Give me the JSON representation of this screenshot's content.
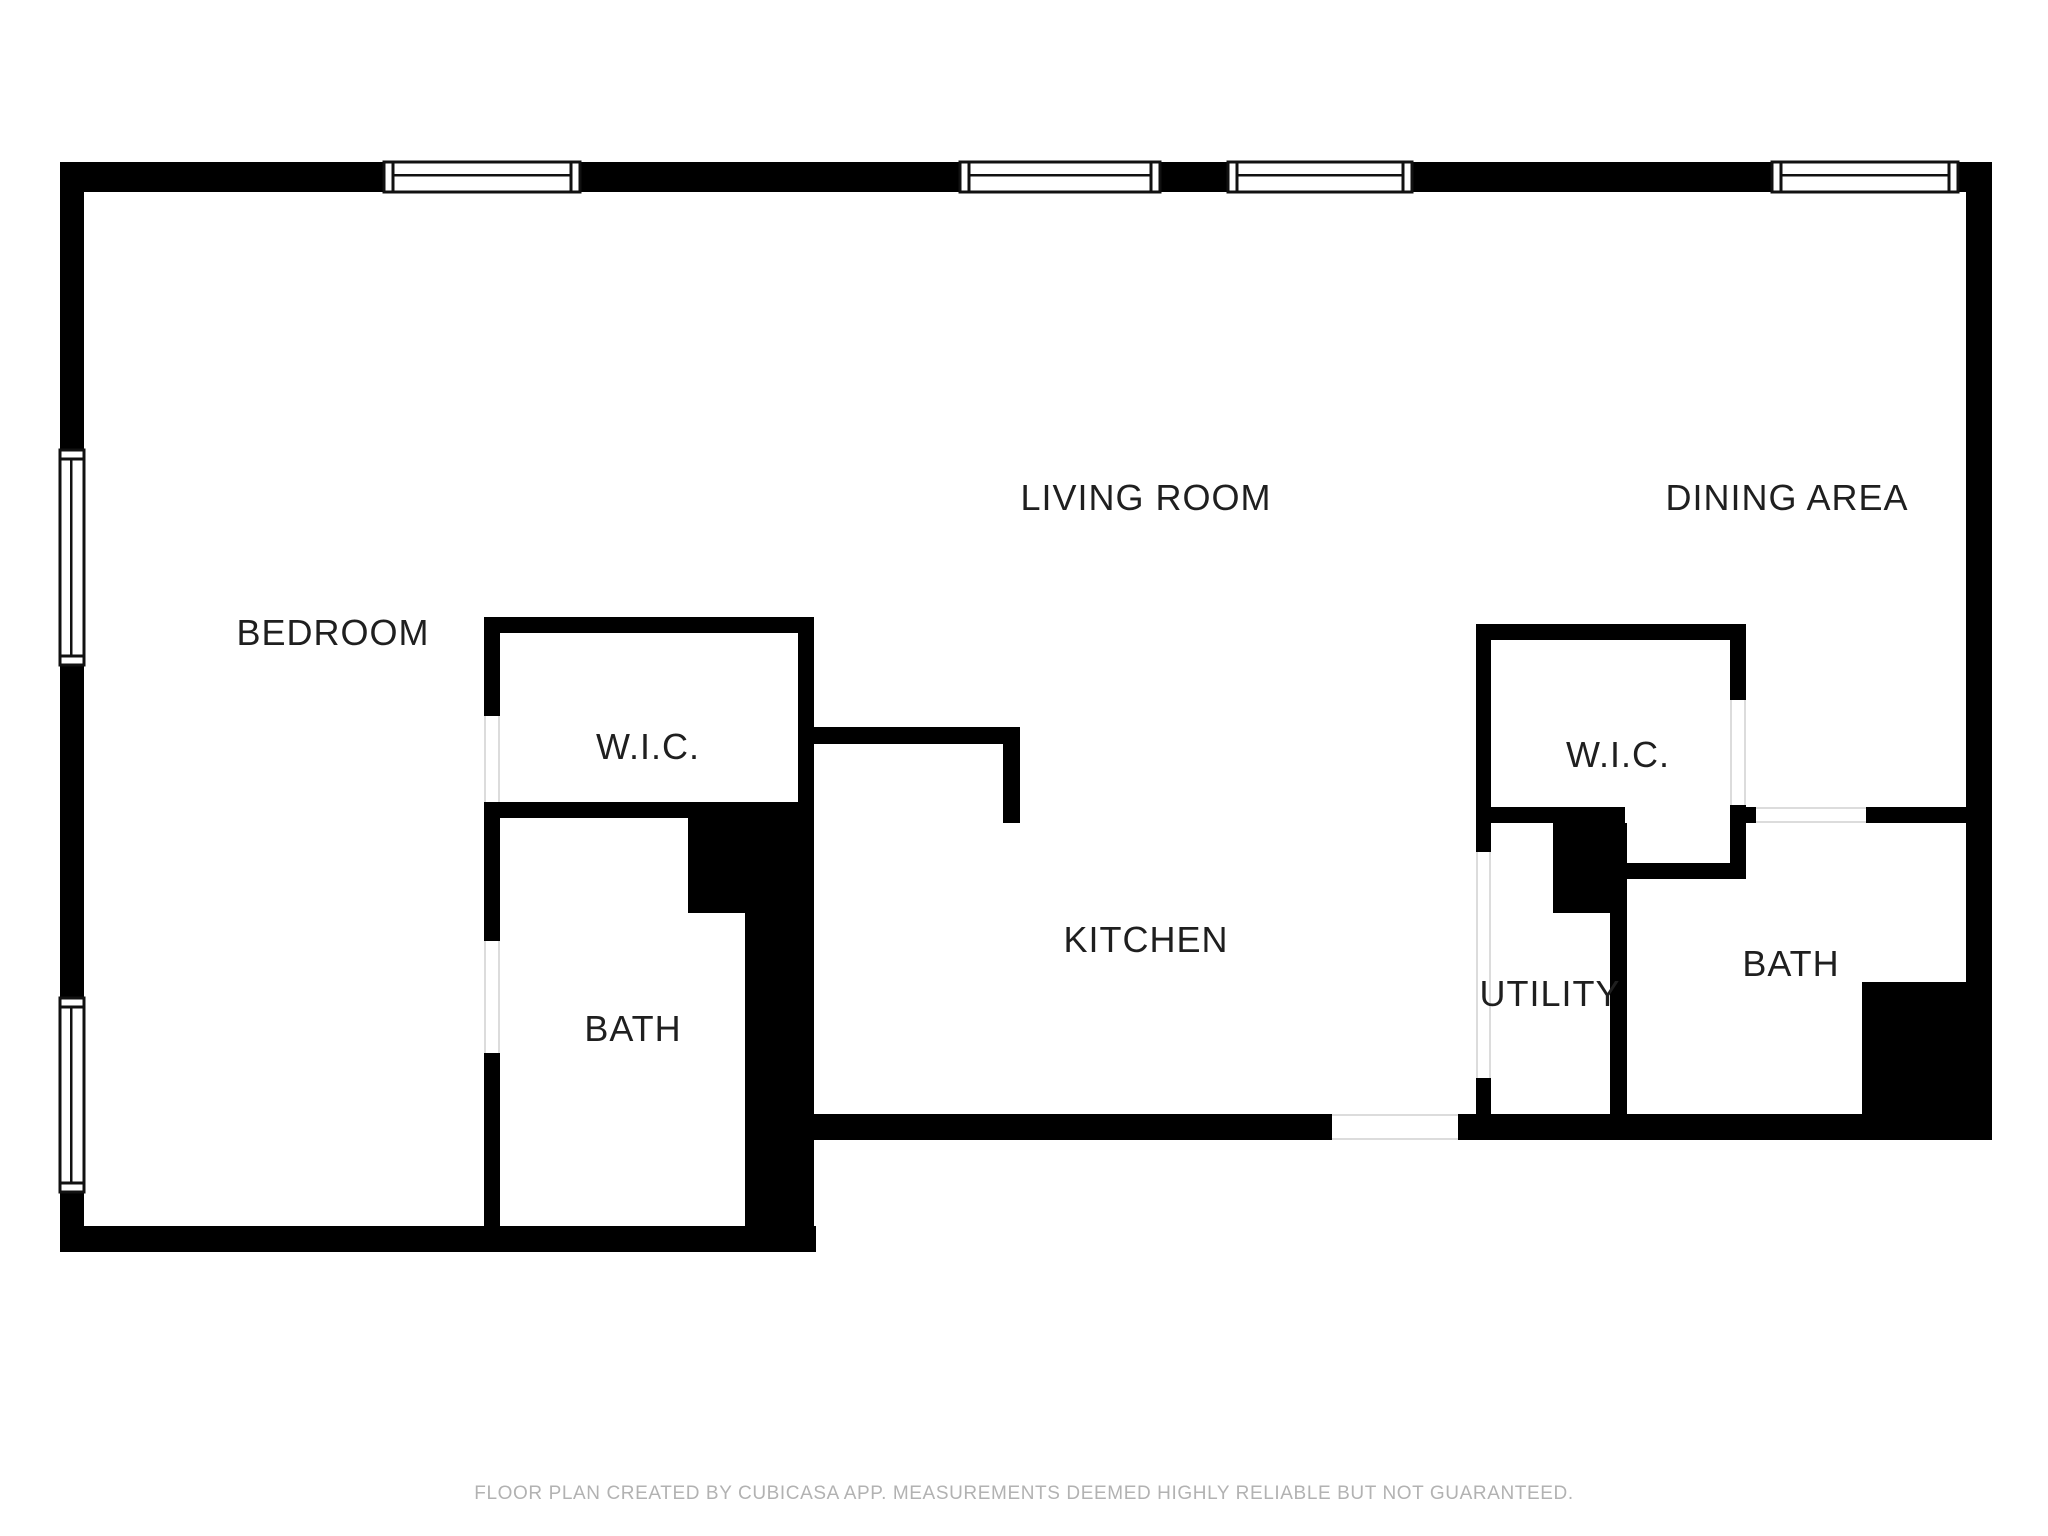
{
  "colors": {
    "background": "#ffffff",
    "wall": "#000000",
    "window_frame": "#111111",
    "window_fill": "#ffffff",
    "door_line": "#dcdcdc",
    "room_label": "#1f1f1f",
    "footer_text": "#b2b2b2"
  },
  "rooms": {
    "living_room": {
      "label": "LIVING ROOM",
      "x": 1146,
      "y": 498
    },
    "dining_area": {
      "label": "DINING AREA",
      "x": 1787,
      "y": 498
    },
    "bedroom": {
      "label": "BEDROOM",
      "x": 333,
      "y": 633
    },
    "wic_left": {
      "label": "W.I.C.",
      "x": 648,
      "y": 747
    },
    "wic_right": {
      "label": "W.I.C.",
      "x": 1618,
      "y": 755
    },
    "kitchen": {
      "label": "KITCHEN",
      "x": 1146,
      "y": 940
    },
    "utility": {
      "label": "UTILITY",
      "x": 1550,
      "y": 994
    },
    "bath_left": {
      "label": "BATH",
      "x": 633,
      "y": 1029
    },
    "bath_right": {
      "label": "BATH",
      "x": 1791,
      "y": 964
    }
  },
  "footer": {
    "text": "FLOOR PLAN CREATED BY CUBICASA APP. MEASUREMENTS DEEMED HIGHLY RELIABLE BUT NOT GUARANTEED."
  },
  "plan": {
    "walls": [
      {
        "name": "exterior-top-1",
        "x": 60,
        "y": 162,
        "w": 324,
        "h": 30
      },
      {
        "name": "exterior-top-2",
        "x": 580,
        "y": 162,
        "w": 380,
        "h": 30
      },
      {
        "name": "exterior-top-3",
        "x": 1160,
        "y": 162,
        "w": 68,
        "h": 30
      },
      {
        "name": "exterior-top-4",
        "x": 1412,
        "y": 162,
        "w": 360,
        "h": 30
      },
      {
        "name": "exterior-top-5",
        "x": 1958,
        "y": 162,
        "w": 34,
        "h": 30
      },
      {
        "name": "exterior-left-1",
        "x": 60,
        "y": 162,
        "w": 24,
        "h": 288
      },
      {
        "name": "exterior-left-2",
        "x": 60,
        "y": 665,
        "w": 24,
        "h": 333
      },
      {
        "name": "exterior-left-3",
        "x": 60,
        "y": 1192,
        "w": 24,
        "h": 60
      },
      {
        "name": "exterior-right",
        "x": 1966,
        "y": 162,
        "w": 26,
        "h": 978
      },
      {
        "name": "exterior-bottom-left",
        "x": 60,
        "y": 1226,
        "w": 756,
        "h": 26
      },
      {
        "name": "exterior-bottom-right-1",
        "x": 800,
        "y": 1114,
        "w": 532,
        "h": 26
      },
      {
        "name": "exterior-bottom-right-2",
        "x": 1458,
        "y": 1114,
        "w": 534,
        "h": 26
      },
      {
        "name": "wic-left-top-wall",
        "x": 484,
        "y": 617,
        "w": 330,
        "h": 16
      },
      {
        "name": "bedroom-divider-1",
        "x": 484,
        "y": 617,
        "w": 16,
        "h": 99
      },
      {
        "name": "bedroom-divider-2",
        "x": 484,
        "y": 802,
        "w": 16,
        "h": 139
      },
      {
        "name": "bedroom-divider-3",
        "x": 484,
        "y": 1053,
        "w": 16,
        "h": 199
      },
      {
        "name": "wic-left-bottom-wall",
        "x": 484,
        "y": 802,
        "w": 330,
        "h": 16
      },
      {
        "name": "wic-left-right-wall",
        "x": 798,
        "y": 617,
        "w": 16,
        "h": 201
      },
      {
        "name": "bath-left-corner-block",
        "x": 688,
        "y": 818,
        "w": 126,
        "h": 95
      },
      {
        "name": "bath-left-right-wall",
        "x": 745,
        "y": 913,
        "w": 69,
        "h": 339
      },
      {
        "name": "kitchen-wall-horizontal",
        "x": 814,
        "y": 727,
        "w": 206,
        "h": 17
      },
      {
        "name": "kitchen-wall-vertical",
        "x": 1003,
        "y": 727,
        "w": 17,
        "h": 96
      },
      {
        "name": "wic-right-top-wall",
        "x": 1476,
        "y": 624,
        "w": 270,
        "h": 16
      },
      {
        "name": "wic-right-left-wall",
        "x": 1476,
        "y": 624,
        "w": 15,
        "h": 228
      },
      {
        "name": "utility-left-wall",
        "x": 1476,
        "y": 1078,
        "w": 15,
        "h": 62
      },
      {
        "name": "wic-right-right-wall-1",
        "x": 1730,
        "y": 624,
        "w": 16,
        "h": 76
      },
      {
        "name": "wic-right-right-wall-2",
        "x": 1730,
        "y": 805,
        "w": 16,
        "h": 74
      },
      {
        "name": "wic-right-bottom-wall",
        "x": 1491,
        "y": 807,
        "w": 134,
        "h": 16
      },
      {
        "name": "utility-corner-block",
        "x": 1553,
        "y": 823,
        "w": 74,
        "h": 90
      },
      {
        "name": "utility-bath-divider",
        "x": 1610,
        "y": 913,
        "w": 17,
        "h": 201
      },
      {
        "name": "bath-right-top-left-wall",
        "x": 1625,
        "y": 863,
        "w": 105,
        "h": 16
      },
      {
        "name": "bath-right-top-wall-1",
        "x": 1746,
        "y": 807,
        "w": 10,
        "h": 16
      },
      {
        "name": "bath-right-top-wall-2",
        "x": 1866,
        "y": 807,
        "w": 100,
        "h": 16
      },
      {
        "name": "bath-right-corner-block",
        "x": 1862,
        "y": 982,
        "w": 104,
        "h": 158
      }
    ],
    "windows": [
      {
        "name": "window-top-1",
        "x": 384,
        "y": 162,
        "w": 196,
        "h": 30,
        "orient": "h"
      },
      {
        "name": "window-top-2",
        "x": 960,
        "y": 162,
        "w": 200,
        "h": 30,
        "orient": "h"
      },
      {
        "name": "window-top-3",
        "x": 1228,
        "y": 162,
        "w": 184,
        "h": 30,
        "orient": "h"
      },
      {
        "name": "window-top-4",
        "x": 1772,
        "y": 162,
        "w": 186,
        "h": 30,
        "orient": "h"
      },
      {
        "name": "window-left-1",
        "x": 60,
        "y": 450,
        "w": 24,
        "h": 215,
        "orient": "v"
      },
      {
        "name": "window-left-2",
        "x": 60,
        "y": 998,
        "w": 24,
        "h": 194,
        "orient": "v"
      }
    ],
    "doors": [
      {
        "name": "door-opening-wic-left",
        "x": 484,
        "y": 716,
        "w": 16,
        "h": 86,
        "orient": "v"
      },
      {
        "name": "door-opening-bath-left",
        "x": 484,
        "y": 941,
        "w": 16,
        "h": 112,
        "orient": "v"
      },
      {
        "name": "door-opening-wic-right",
        "x": 1730,
        "y": 700,
        "w": 16,
        "h": 105,
        "orient": "v"
      },
      {
        "name": "door-opening-utility",
        "x": 1476,
        "y": 852,
        "w": 15,
        "h": 226,
        "orient": "v"
      },
      {
        "name": "door-opening-bath-right",
        "x": 1756,
        "y": 807,
        "w": 110,
        "h": 16,
        "orient": "h"
      },
      {
        "name": "door-opening-entry",
        "x": 1332,
        "y": 1114,
        "w": 126,
        "h": 26,
        "orient": "h"
      }
    ]
  }
}
